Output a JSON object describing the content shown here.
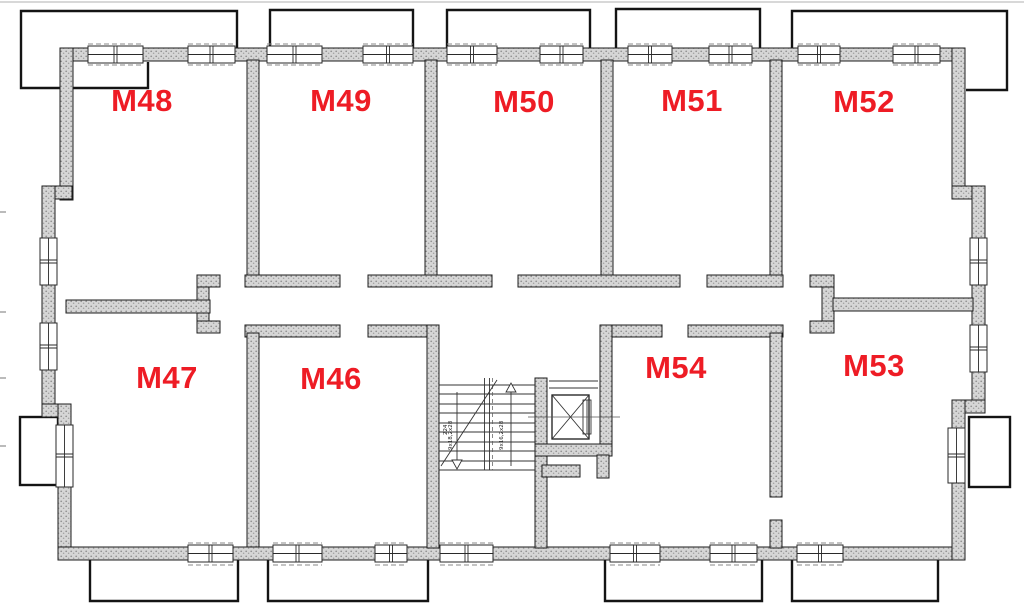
{
  "plan": {
    "type": "apartment-floor-plan",
    "label_color": "#ee1c25",
    "wall_color": "#d6d6d6",
    "line_color": "#1c1c1c",
    "rooms": [
      {
        "label": "M48",
        "row": "top"
      },
      {
        "label": "M49",
        "row": "top"
      },
      {
        "label": "M50",
        "row": "top"
      },
      {
        "label": "M51",
        "row": "top"
      },
      {
        "label": "M52",
        "row": "top"
      },
      {
        "label": "M47",
        "row": "bottom"
      },
      {
        "label": "M46",
        "row": "bottom"
      },
      {
        "label": "M54",
        "row": "bottom"
      },
      {
        "label": "M53",
        "row": "bottom"
      }
    ],
    "stairs": {
      "riser_note_left_a": "9x18,2x28",
      "riser_note_left_b": "224",
      "riser_note_right": "9x16,2x28"
    }
  }
}
